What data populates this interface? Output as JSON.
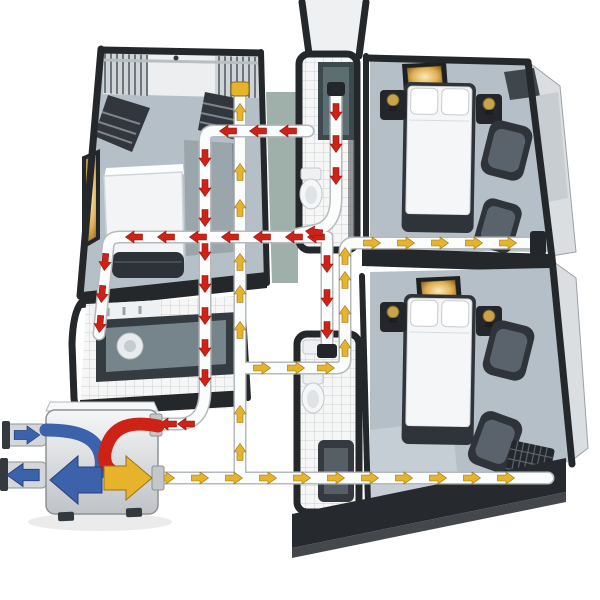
{
  "diagram": {
    "kind": "isometric-cutaway-home-ventilation-diagram",
    "unit": "heat-recovery-ventilation-unit",
    "rooms": [
      "living-room",
      "shower-room",
      "bedroom-top",
      "bathroom-tub",
      "bathroom-bottom",
      "bedroom-bottom"
    ],
    "ceiling_vents": [
      "bedroom-top-supply-vent",
      "bedroom-bottom-supply-vent"
    ],
    "airflows": [
      {
        "id": "extract-air",
        "color_key": "extract_air"
      },
      {
        "id": "supply-air",
        "color_key": "supply_air"
      },
      {
        "id": "fresh-outdoor-air",
        "color_key": "fresh_air"
      },
      {
        "id": "exhaust-air",
        "color_key": "fresh_air"
      }
    ]
  },
  "colors": {
    "extract_air": "#ce2217",
    "extract_edge": "#8e1710",
    "supply_air": "#e6b32b",
    "supply_edge": "#97731a",
    "fresh_air": "#3c62ac",
    "fresh_edge": "#27407c",
    "duct_fill": "#fbfcfc",
    "duct_stroke": "#b7babc",
    "wall_dark": "#24282b",
    "wall_face": "#dadee1",
    "floor": "#b4bfc7",
    "corridor": "#9fb0ab",
    "tile": "#f5f6f5",
    "tile_line": "#ccd0d2",
    "furniture_dark": "#2e343a",
    "furniture_mid": "#5a636b",
    "bed_white": "#f5f6f7",
    "brass": "#c9a34a",
    "shower_teal": "#41504f",
    "slab": "#26292d",
    "slab_face": "#44484d",
    "vent_glow": "#fce9b8",
    "vent_mid": "#e0b055",
    "vent_deep": "#7c560f"
  }
}
